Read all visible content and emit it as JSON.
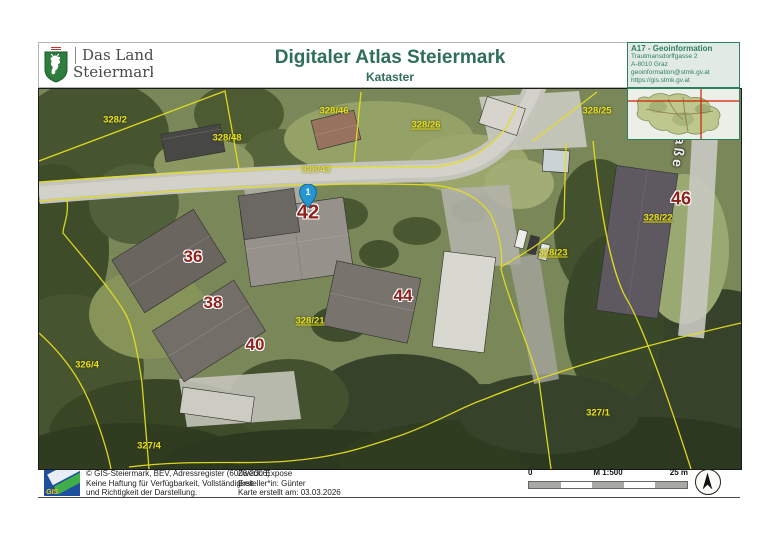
{
  "header": {
    "logo": {
      "line1": "Das Land",
      "line2": "Steiermark"
    },
    "title": "Digitaler Atlas Steiermark",
    "subtitle": "Kataster",
    "contact": {
      "line1": "A17 - Geoinformation",
      "line2": "Trautmansdorffgasse 2",
      "line3": "A-8010 Graz",
      "line4": "geoinformation@stmk.gv.at",
      "line5": "https://gis.stmk.gv.at"
    }
  },
  "map": {
    "marker": {
      "label": "1",
      "x": 308,
      "y": 208
    },
    "street_label": "aße",
    "parcel_labels": [
      {
        "text": "328/2",
        "x": 115,
        "y": 120
      },
      {
        "text": "328/48",
        "x": 227,
        "y": 138
      },
      {
        "text": "328/46",
        "x": 334,
        "y": 111
      },
      {
        "text": "328/26",
        "x": 426,
        "y": 125,
        "u": true
      },
      {
        "text": "328/25",
        "x": 597,
        "y": 111
      },
      {
        "text": "328/43",
        "x": 316,
        "y": 170,
        "faint": true
      },
      {
        "text": "328/21",
        "x": 310,
        "y": 321,
        "u": true
      },
      {
        "text": "328/23",
        "x": 553,
        "y": 253,
        "u": true
      },
      {
        "text": "328/22",
        "x": 658,
        "y": 218,
        "u": true
      },
      {
        "text": "326/4",
        "x": 87,
        "y": 365
      },
      {
        "text": "327/4",
        "x": 149,
        "y": 446
      },
      {
        "text": "327/1",
        "x": 598,
        "y": 413
      }
    ],
    "house_numbers": [
      {
        "text": "36",
        "x": 193,
        "y": 257,
        "s": 17
      },
      {
        "text": "38",
        "x": 213,
        "y": 303,
        "s": 17
      },
      {
        "text": "40",
        "x": 255,
        "y": 345,
        "s": 17
      },
      {
        "text": "42",
        "x": 308,
        "y": 213,
        "s": 20
      },
      {
        "text": "44",
        "x": 403,
        "y": 296,
        "s": 17
      },
      {
        "text": "46",
        "x": 681,
        "y": 199,
        "s": 18
      }
    ]
  },
  "footer": {
    "gis_logo_text": "GIS",
    "copyright_lines": [
      "© GIS-Steiermark, BEV, Adressregister (6008/2006)",
      "Keine Haftung für Verfügbarkeit, Vollständigkeit",
      "und Richtigkeit der Darstellung."
    ],
    "purpose": "Zweck: Expose",
    "creator": "Ersteller*in: Günter",
    "created": "Karte erstellt am: 03.03.2026",
    "scale": {
      "zero": "0",
      "ratio": "M 1:500",
      "max": "25 m"
    }
  },
  "colors": {
    "title_green": "#2f6e58",
    "contact_green": "#2e8061",
    "parcel_yellow": "#e8e11c",
    "house_red": "#8f231c",
    "marker_blue": "#2596d1",
    "crosshair_red": "#cc2200"
  }
}
